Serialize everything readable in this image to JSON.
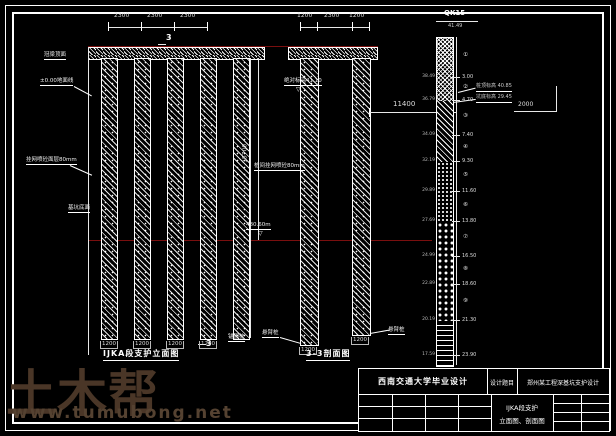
{
  "colors": {
    "background": "#000000",
    "line": "#ffffff",
    "excavation_level_red": "#7a0f0f",
    "watermark": "#4a3627"
  },
  "elevation_view": {
    "caption": "IJKA段支护立面图",
    "section_number": "3",
    "top_dims": [
      "2300",
      "2300",
      "2300"
    ],
    "pile_width_dims": [
      "1200",
      "1200",
      "1200",
      "1200"
    ],
    "labels": {
      "crown_beam": "冠梁顶面",
      "ground": "±0.00地面线",
      "shotcrete": "挂网喷砼面层80mm",
      "pit_bottom": "基坑底面",
      "pile_mesh": "桩间挂网喷砼80mm",
      "pit_bottom_elev": "480.60m",
      "anchor_pile": "锚固桩",
      "total_height_dim": "15700"
    }
  },
  "section_view": {
    "caption": "3-3剖面图",
    "top_dims": [
      "1200",
      "2300",
      "1200"
    ],
    "datum_note": "绝对标高41.10",
    "datum_symbol": "▽",
    "borehole_offset_dim": "11400",
    "pile_width_dims": [
      "1200",
      "1200"
    ],
    "pile_labels": [
      "悬臂桩",
      "悬臂桩"
    ],
    "leader_notes": [
      "桩顶标高 40.85",
      "坑底标高 29.45"
    ],
    "offset_dim": "2000"
  },
  "borehole": {
    "name": "QK15",
    "ground_elevation": "41.49",
    "boundaries": [
      {
        "depth": "3.00",
        "elev": "38.49"
      },
      {
        "depth": "4.70",
        "elev": "36.79"
      },
      {
        "depth": "7.40",
        "elev": "34.09"
      },
      {
        "depth": "9.30",
        "elev": "32.19"
      },
      {
        "depth": "11.60",
        "elev": "29.89"
      },
      {
        "depth": "13.80",
        "elev": "27.69"
      },
      {
        "depth": "16.50",
        "elev": "24.99"
      },
      {
        "depth": "18.60",
        "elev": "22.89"
      },
      {
        "depth": "21.30",
        "elev": "20.19"
      },
      {
        "depth": "23.90",
        "elev": "17.59"
      }
    ],
    "layer_ids": [
      "①",
      "②",
      "③",
      "④",
      "⑤",
      "⑥",
      "⑦",
      "⑧",
      "⑨"
    ]
  },
  "title_block": {
    "university": "西南交通大学毕业设计",
    "field_label": "设计题目",
    "project": "郑州某工程深基坑支护设计",
    "sheet_line1": "IJKA段支护",
    "sheet_line2": "立面图、剖面图"
  },
  "watermark": {
    "brand": "土木帮",
    "site": "www.tumubong.net"
  }
}
